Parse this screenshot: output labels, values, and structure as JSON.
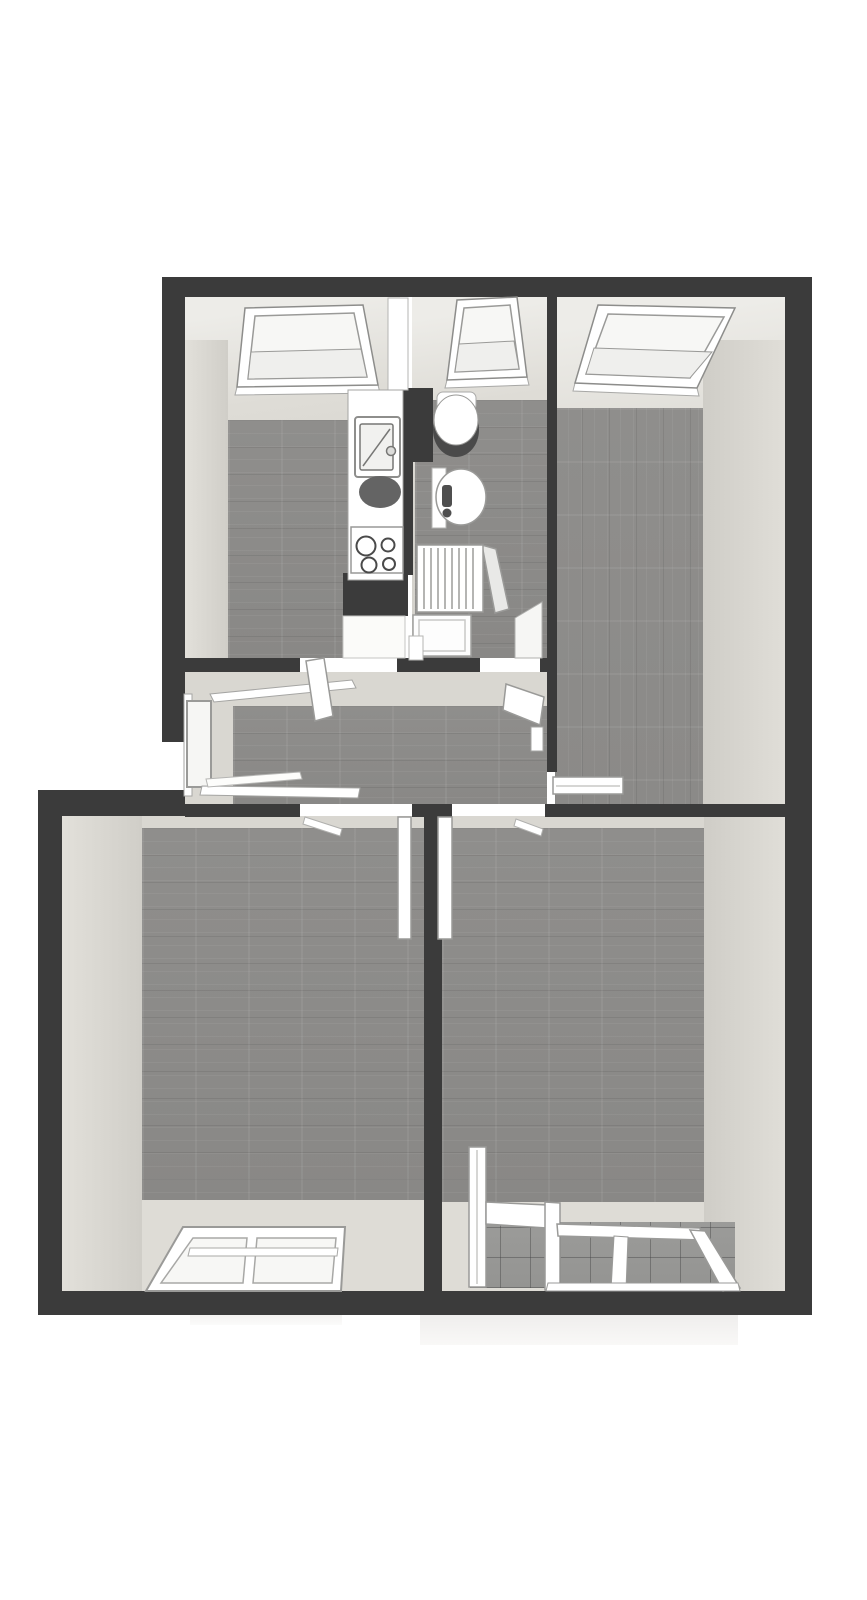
{
  "canvas": {
    "width": 867,
    "height": 1600,
    "background": "#ffffff"
  },
  "colors": {
    "paper": "#ffffff",
    "wall": "#3b3b3b",
    "face": "#d9d7d1",
    "faceLight": "#dedcd6",
    "wood": "#8f8e8c",
    "tileGrout": "#6f6f6d",
    "frame": "#ffffff",
    "stroke": "#9a9a98",
    "glass": "#f6f6f4",
    "glassTint": "#e9e9e6",
    "fixtureDark": "#4a4a4a",
    "basinDark": "#646464",
    "shadow": "#efeeed"
  },
  "scene": {
    "type": "3d-floor-plan-render",
    "view": "top-down dollhouse perspective, unfurnished attic apartment",
    "rooms": [
      {
        "id": "kitchen",
        "position": "top-left",
        "floor": "wood",
        "fixtures": [
          "roof-window",
          "kitchen-counter",
          "sink",
          "dark-basin",
          "cooktop-4-burners",
          "chimney-block"
        ]
      },
      {
        "id": "bathroom",
        "position": "top-middle",
        "floor": "wood",
        "fixtures": [
          "roof-window",
          "toilet",
          "washbasin",
          "radiator",
          "shower-tray",
          "glass-screen"
        ]
      },
      {
        "id": "room-top-right",
        "position": "top-right",
        "floor": "wood",
        "fixtures": [
          "roof-window",
          "open-door-leaf"
        ]
      },
      {
        "id": "hallway",
        "position": "middle",
        "floor": "wood",
        "fixtures": [
          "side-window-bay",
          "door-openings"
        ]
      },
      {
        "id": "room-bottom-left",
        "position": "bottom-left",
        "floor": "wood",
        "fixtures": [
          "south-window-2-panes",
          "open-door-leaf"
        ]
      },
      {
        "id": "room-bottom-right",
        "position": "bottom-right",
        "floor": "wood",
        "fixtures": [
          "glazed-loggia",
          "tiled-balcony-floor",
          "south-glazing-2-panes",
          "glass-partition",
          "open-door-leaf"
        ]
      }
    ],
    "window_counts": {
      "roof_windows": 3,
      "facade_windows": 3,
      "glass_partitions": 2
    },
    "door_count": 5
  }
}
